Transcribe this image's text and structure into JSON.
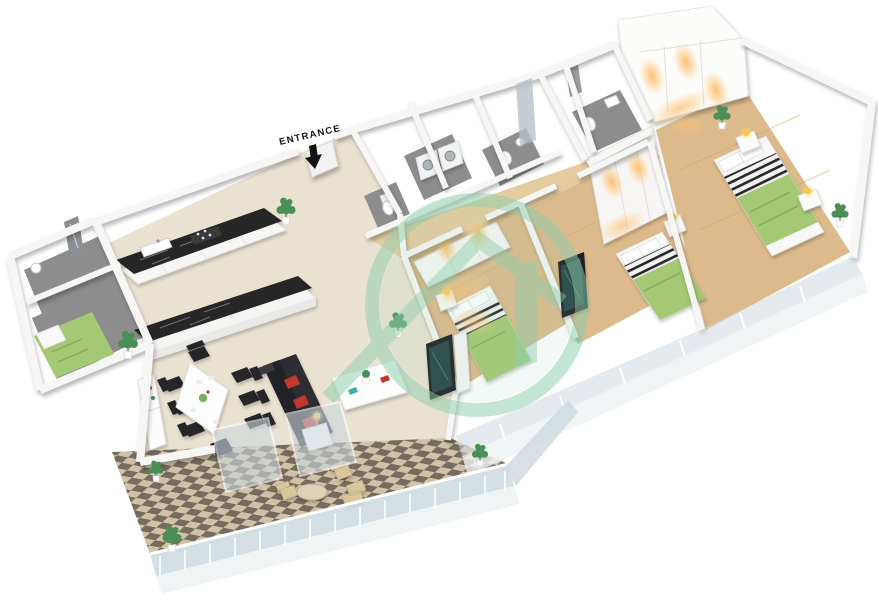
{
  "scene": {
    "background": "#ffffff",
    "entrance": {
      "label": "ENTRANCE"
    },
    "watermark": {
      "icon": "house-in-circle-logo"
    },
    "colors": {
      "label": "#141414",
      "watermark": "#8ecfad",
      "wall": "#f6f6f5",
      "floor": "#e9e2d1",
      "wood": "#dcba8c",
      "wood_hall": "#e4cba0",
      "gray_floor": "#8d8d8d",
      "tile_light": "#cfc2a6",
      "tile_dark": "#776a5e",
      "marble": "#262626",
      "bed_green": "#a4c873",
      "sofa": "#2e2e32",
      "cushion": "#c0392f",
      "chair": "#28282a",
      "lamp": "#f6c84a",
      "plant": "#4b8f58",
      "glass": "#cdd9df",
      "outdoor": "#d9c79b",
      "screen": "#2a4a49"
    },
    "rooms": [
      "entrance hall",
      "kitchen",
      "dining area",
      "living room",
      "balcony",
      "maid room",
      "bathrooms",
      "laundry",
      "bedroom",
      "bedroom",
      "master bedroom",
      "walk-in wardrobe"
    ],
    "furniture": [
      "kitchen counter",
      "kitchen island",
      "dining table with chairs",
      "sofa",
      "coffee table",
      "tv",
      "double beds",
      "single bed",
      "washer and dryer",
      "wardrobes",
      "nightstands with lamps",
      "outdoor table and chairs",
      "plants"
    ]
  }
}
